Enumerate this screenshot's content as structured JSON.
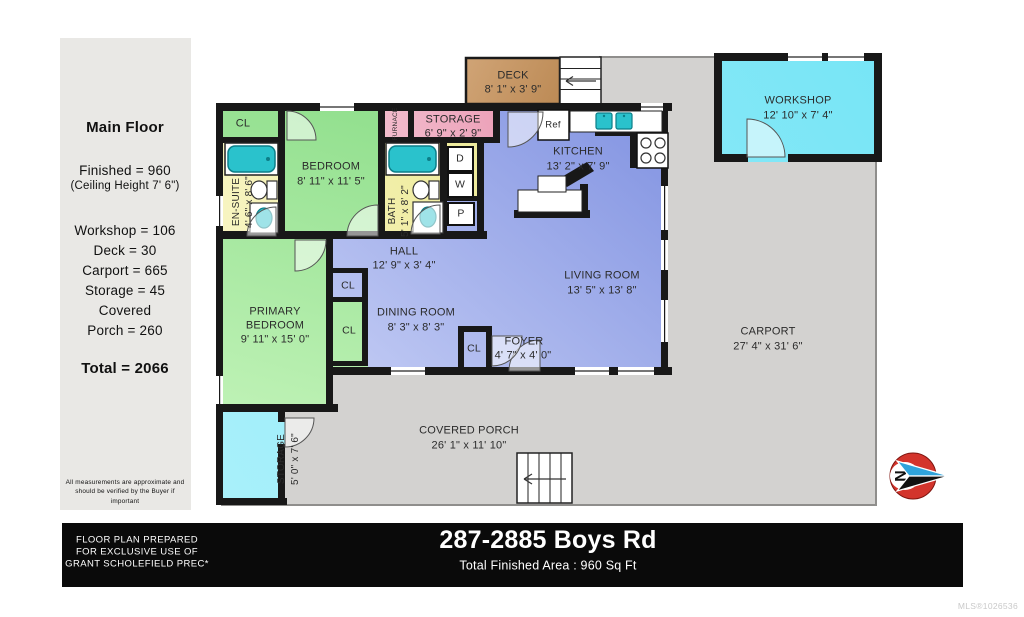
{
  "sidebar": {
    "title": "Main Floor",
    "finished": "Finished = 960",
    "ceiling": "(Ceiling Height  7' 6\")",
    "areas": [
      "Workshop = 106",
      "Deck = 30",
      "Carport = 665",
      "Storage = 45",
      "Covered",
      "Porch = 260"
    ],
    "total": "Total = 2066",
    "disclaimer": "All measurements are approximate and should be verified by the Buyer if important"
  },
  "plan": {
    "rooms": {
      "deck": {
        "name": "DECK",
        "dims": "8' 1\" x 3' 9\""
      },
      "workshop": {
        "name": "WORKSHOP",
        "dims": "12' 10\" x 7' 4\""
      },
      "storage_top": {
        "name": "STORAGE",
        "dims": "6' 9\" x 2' 9\""
      },
      "kitchen": {
        "name": "KITCHEN",
        "dims": "13' 2\" x 7' 9\""
      },
      "bedroom": {
        "name": "BEDROOM",
        "dims": "8' 11\" x 11' 5\""
      },
      "ensuite": {
        "name": "EN-SUITE",
        "dims": "4' 6\" x 8' 6\""
      },
      "bath": {
        "name": "BATH",
        "dims": "5' 1\" x 8' 2\""
      },
      "hall": {
        "name": "HALL",
        "dims": "12' 9\" x 3' 4\""
      },
      "living": {
        "name": "LIVING ROOM",
        "dims": "13' 5\" x 13' 8\""
      },
      "dining": {
        "name": "DINING ROOM",
        "dims": "8' 3\" x 8' 3\""
      },
      "foyer": {
        "name": "FOYER",
        "dims": "4' 7\" x 4' 0\""
      },
      "primary": {
        "name1": "PRIMARY",
        "name2": "BEDROOM",
        "dims": "9' 11\" x 15' 0\""
      },
      "carport": {
        "name": "CARPORT",
        "dims": "27' 4\" x 31' 6\""
      },
      "porch": {
        "name": "COVERED PORCH",
        "dims": "26' 1\" x 11' 10\""
      },
      "storage_bl": {
        "name": "STORAGE",
        "dims": "5' 0\" x 7' 6\""
      }
    },
    "labels": {
      "closet": "CL",
      "furnace": "FURNACE",
      "fridge": "Ref",
      "dryer": "D",
      "washer": "W",
      "pantry": "P",
      "north": "N"
    }
  },
  "footer": {
    "prepared_lines": [
      "FLOOR PLAN PREPARED",
      "FOR EXCLUSIVE USE OF",
      "GRANT SCHOLEFIELD PREC*"
    ],
    "address": "287-2885 Boys Rd",
    "total_area": "Total Finished Area : 960 Sq Ft"
  },
  "watermark": "MLS®1026536",
  "colors": {
    "finished_floor": "#9FAFEA",
    "bedroom_green": "#A8E79E",
    "bath_yellow": "#F3F0AC",
    "storage_pink": "#EFA9BE",
    "workshop_cyan": "#8DEBF7",
    "deck_tan": "#C59868",
    "slab_gray": "#D3D2D0",
    "fixture_teal": "#2AC2CC",
    "wall_black": "#181818"
  }
}
